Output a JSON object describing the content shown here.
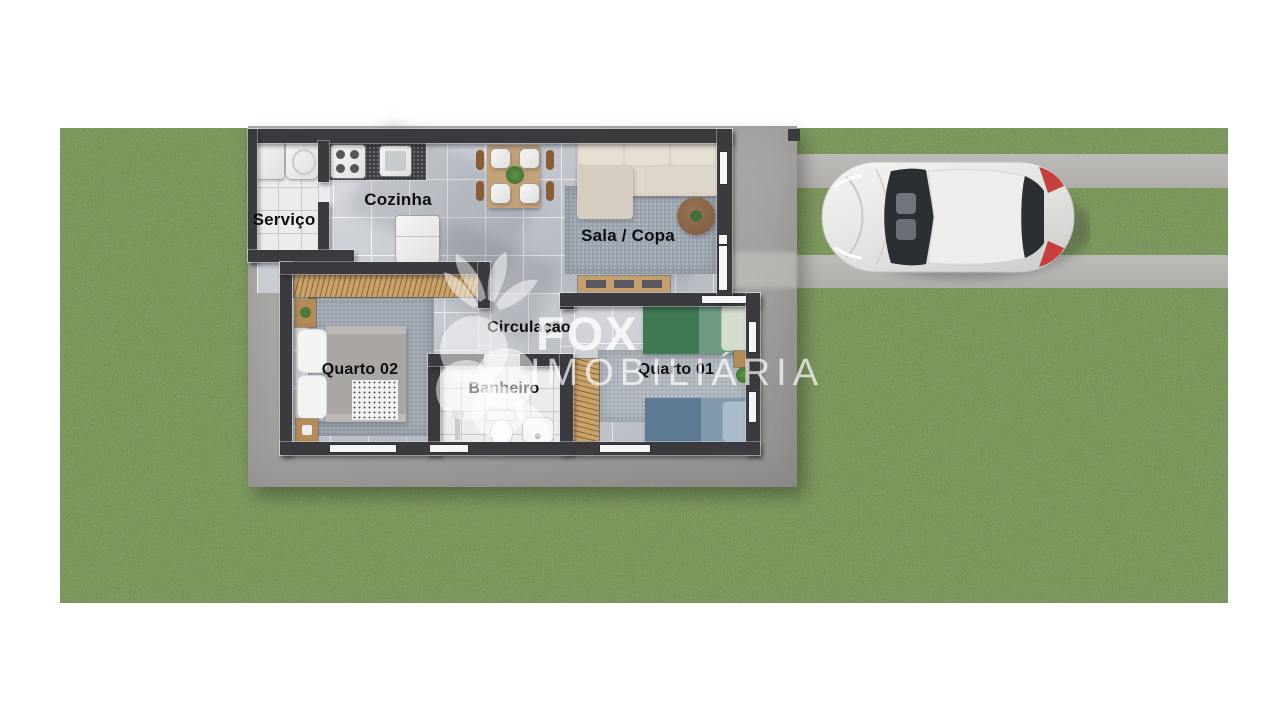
{
  "scene": {
    "description": "Top-down 3D architectural floor plan render of a small house on a grass lot with a two-strip concrete driveway and a parked white hatchback car"
  },
  "rooms": {
    "servico": "Serviço",
    "cozinha": "Cozinha",
    "sala_copa": "Sala / Copa",
    "quarto02": "Quarto 02",
    "circulacao": "Circulação",
    "banheiro": "Banheiro",
    "quarto01": "Quarto 01"
  },
  "watermark": {
    "brand": "FOX",
    "subtitle": "IMOBILIÁRIA"
  },
  "colors": {
    "background": "#ffffff",
    "grass": "#3e4a29",
    "concrete_pad": "#a8a6a4",
    "driveway_strip": "#b8b6b3",
    "walls": "#3a3a3f",
    "floor_tiles": "#c9ccd3",
    "wet_area_tiles": "#eaecee",
    "car_body": "#e9e9e7",
    "car_taillights": "#c5403c",
    "watermark": "#ffffff"
  }
}
